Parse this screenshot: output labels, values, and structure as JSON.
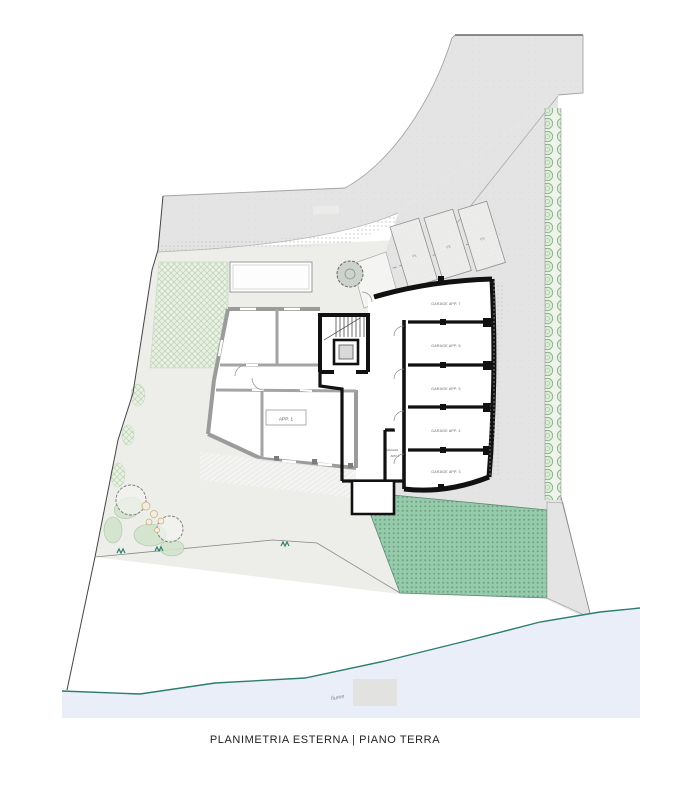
{
  "title": "PLANIMETRIA ESTERNA | PIANO TERRA",
  "plan": {
    "apartment_label": "APP. 1",
    "storage_label_line1": "MAGAZZINO",
    "storage_label_line2": "APP. 2",
    "garage_labels": [
      "GARAGE APP. 7",
      "GARAGE APP. 6",
      "GARAGE APP. 5",
      "GARAGE APP. 4",
      "GARAGE APP. 3"
    ],
    "parking_labels": [
      "P1",
      "P2",
      "P3"
    ],
    "river_label": "fiume",
    "colors": {
      "road": "#e3e4e3",
      "lawn": "#edeeea",
      "garden_hatch": "#e9f0e4",
      "hedge_green": "#7fae83",
      "embankment_green": "#97c9ab",
      "water": "#e9eef8",
      "shoreline": "#2e7d6e",
      "wall_black": "#111111",
      "wall_gray": "#9b9b9b"
    }
  }
}
